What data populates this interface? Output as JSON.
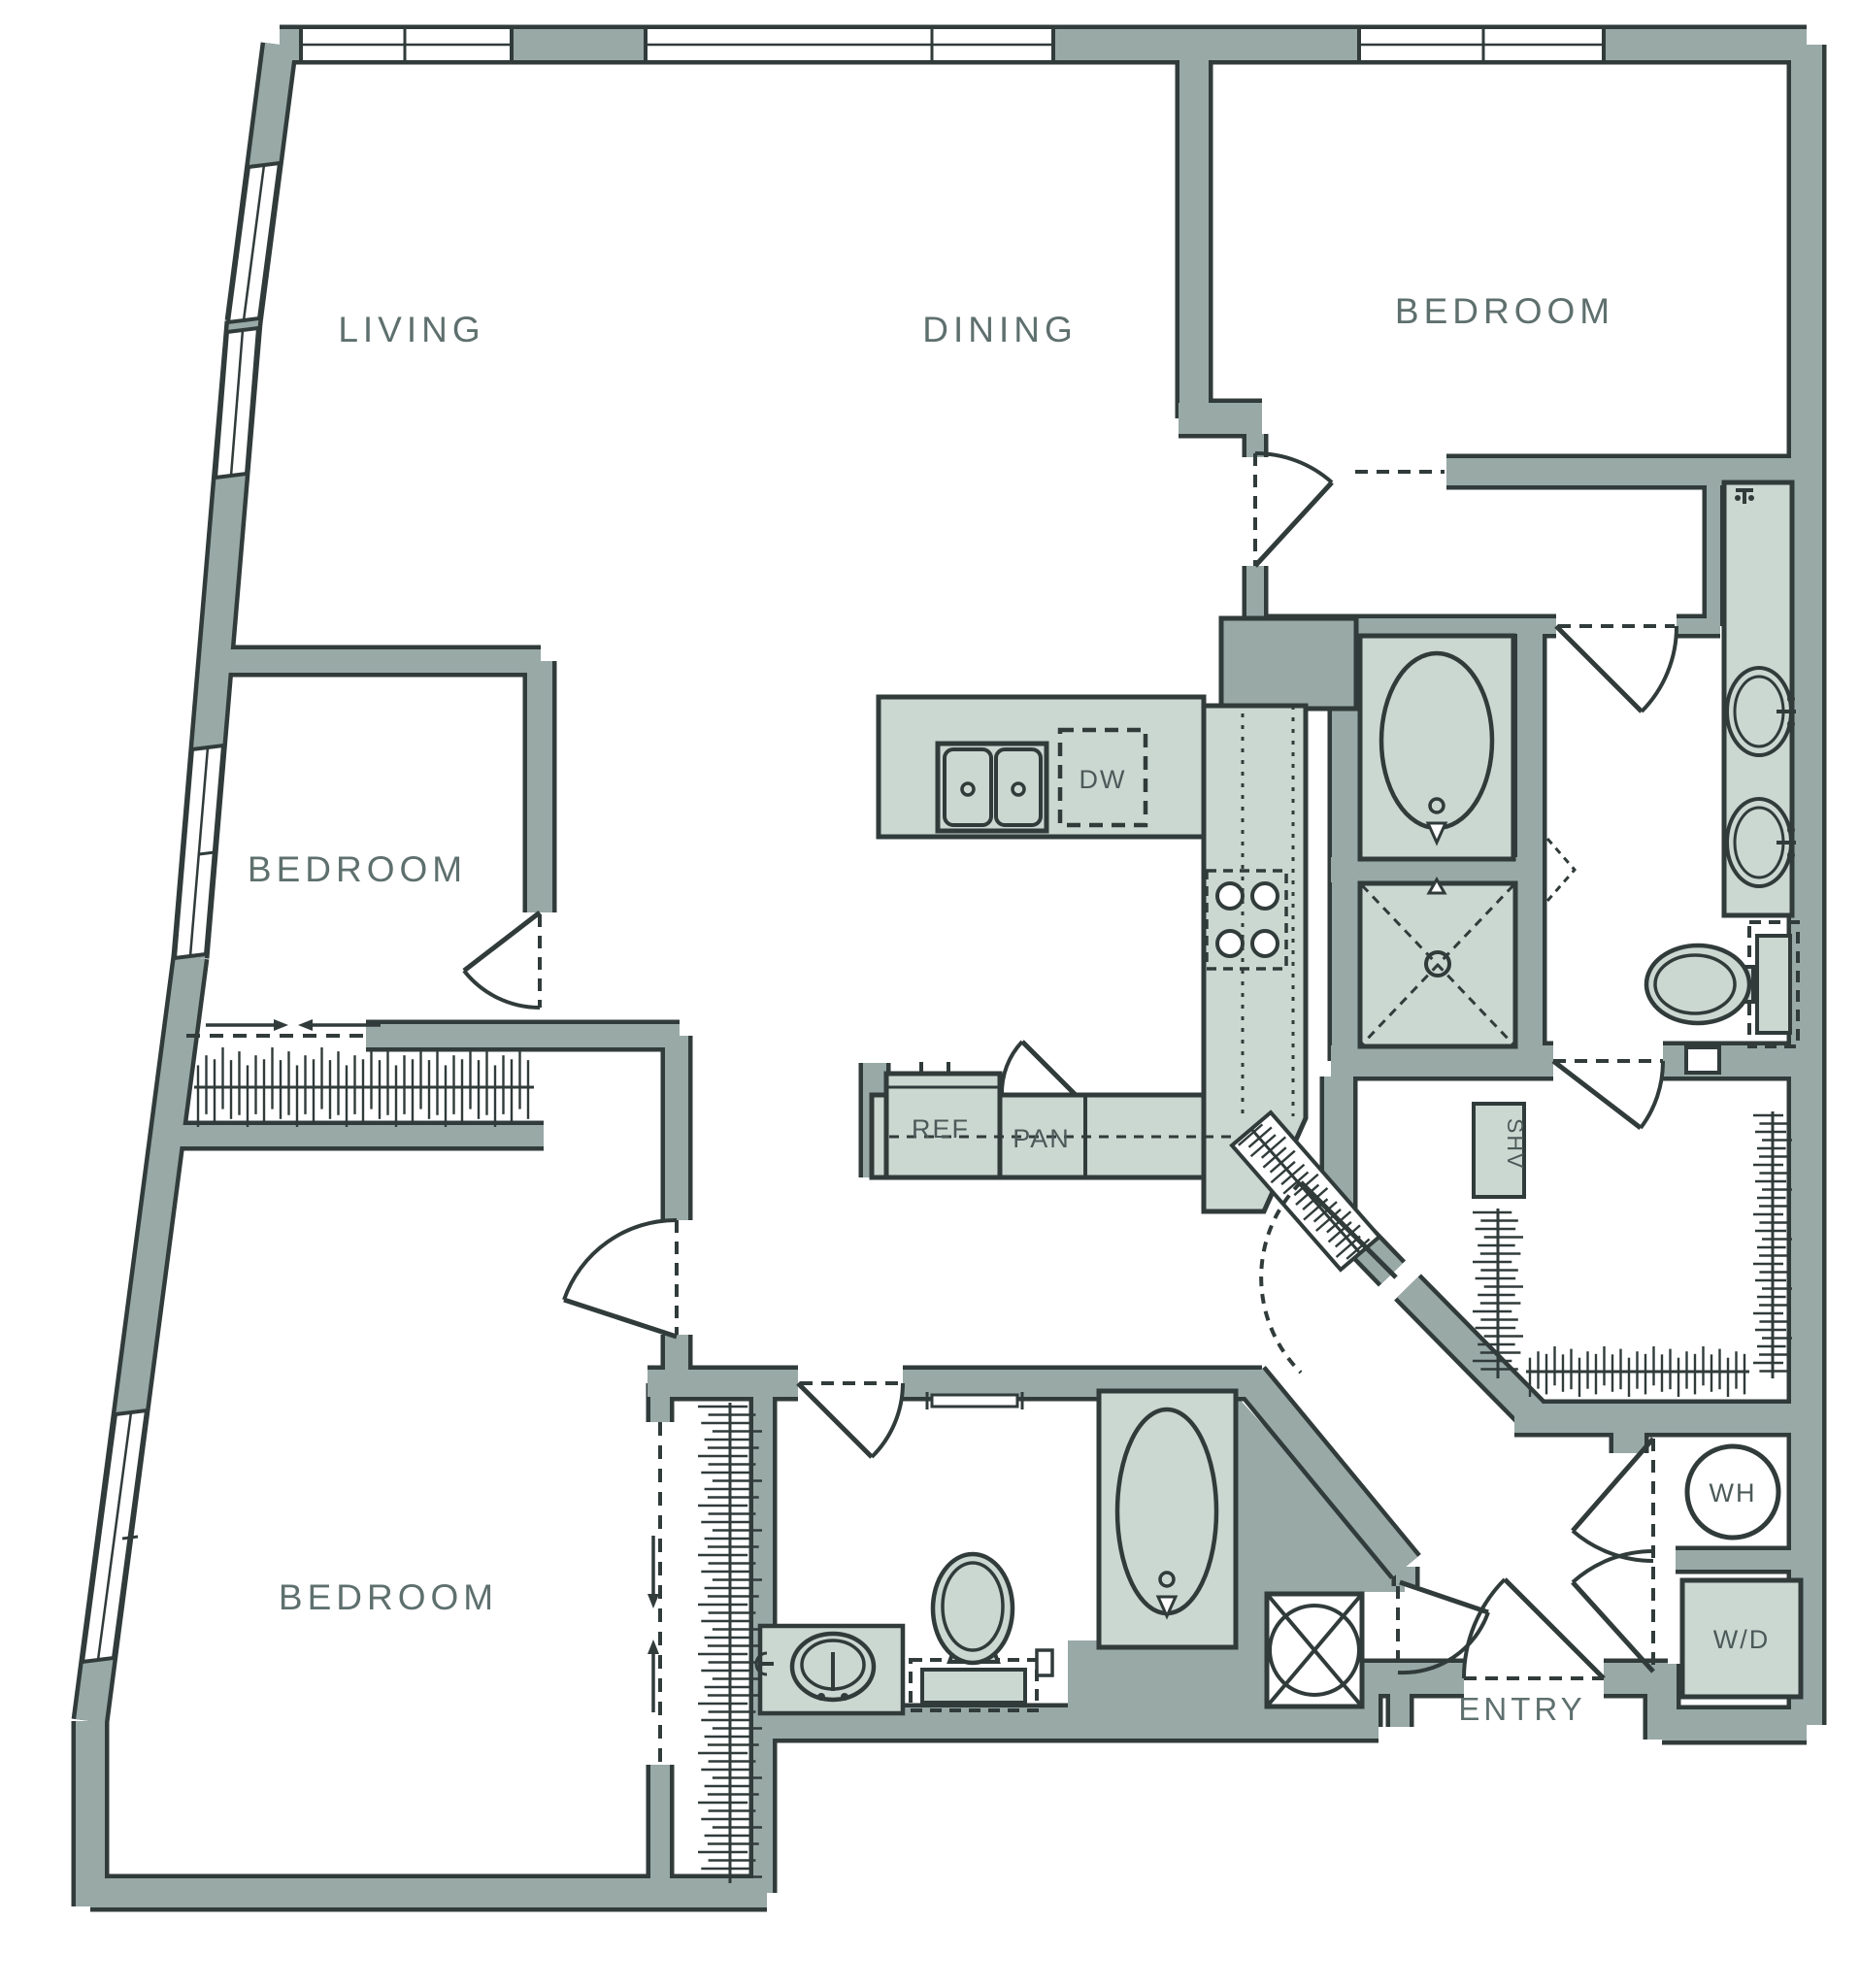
{
  "plan": {
    "type": "apartment-floor-plan",
    "labels": {
      "living": "LIVING",
      "dining": "DINING",
      "bedroom_top_right": "BEDROOM",
      "bedroom_middle_left": "BEDROOM",
      "bedroom_bottom_left": "BEDROOM",
      "dishwasher": "DW",
      "refrigerator": "REF",
      "pantry": "PAN",
      "shelves": "SHV",
      "water_heater": "WH",
      "washer_dryer": "W/D",
      "entry": "ENTRY"
    },
    "colors": {
      "background": "#ffffff",
      "wall_fill": "#98a9a6",
      "fixture_fill": "#cbd7d1",
      "line_dark": "#303b3a",
      "label_text": "#5e706e"
    },
    "symbols": [
      {
        "name": "double-kitchen-sink"
      },
      {
        "name": "range-4-burners"
      },
      {
        "name": "oval-bathtub",
        "count": 2
      },
      {
        "name": "shower-dashed-x"
      },
      {
        "name": "toilet",
        "count": 2
      },
      {
        "name": "vanity-sink",
        "count": 3
      },
      {
        "name": "water-heater-circle"
      },
      {
        "name": "washer-dryer-unit"
      },
      {
        "name": "closet-rod-hatching",
        "count": 6
      },
      {
        "name": "door-swing-arc",
        "count": 10
      },
      {
        "name": "sliding-door-arrows",
        "count": 2
      },
      {
        "name": "window",
        "count": 7
      }
    ]
  }
}
